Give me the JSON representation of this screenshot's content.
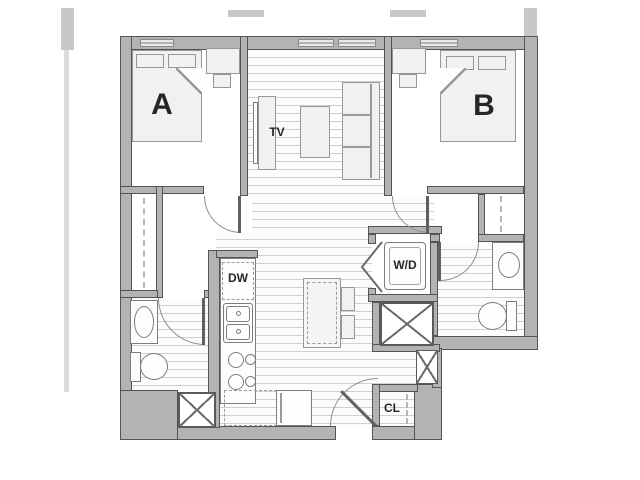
{
  "floor_plan": {
    "labels": {
      "bedroom_a": "A",
      "bedroom_b": "B",
      "tv": "TV",
      "dishwasher": "DW",
      "washer_dryer": "W/D",
      "entry_closet": "CL"
    },
    "colors": {
      "background": "#ffffff",
      "wall_fill": "#b3b3b3",
      "wall_outline": "#545454",
      "floor_line": "#d0d0d0",
      "furniture_fill": "#f1f1f1",
      "label_text": "#262626"
    }
  }
}
